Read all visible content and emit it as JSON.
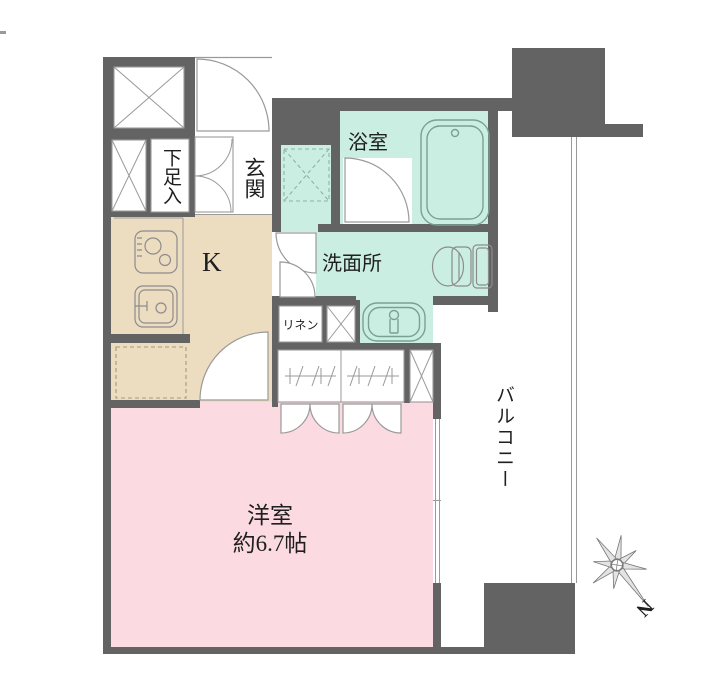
{
  "colors": {
    "wall": "#636363",
    "water_rooms": "#cbeee2",
    "kitchen_floor": "#ecdcc0",
    "western_room": "#fcdae2",
    "line": "#9a9a9a"
  },
  "labels": {
    "entrance": "玄関",
    "shoe_cabinet": "下足入",
    "kitchen": "K",
    "bathroom": "浴室",
    "washroom": "洗面所",
    "linen": "リネン",
    "room_name": "洋室",
    "room_size": "約6.7帖",
    "balcony": "バルコニー",
    "compass_north": "N"
  }
}
